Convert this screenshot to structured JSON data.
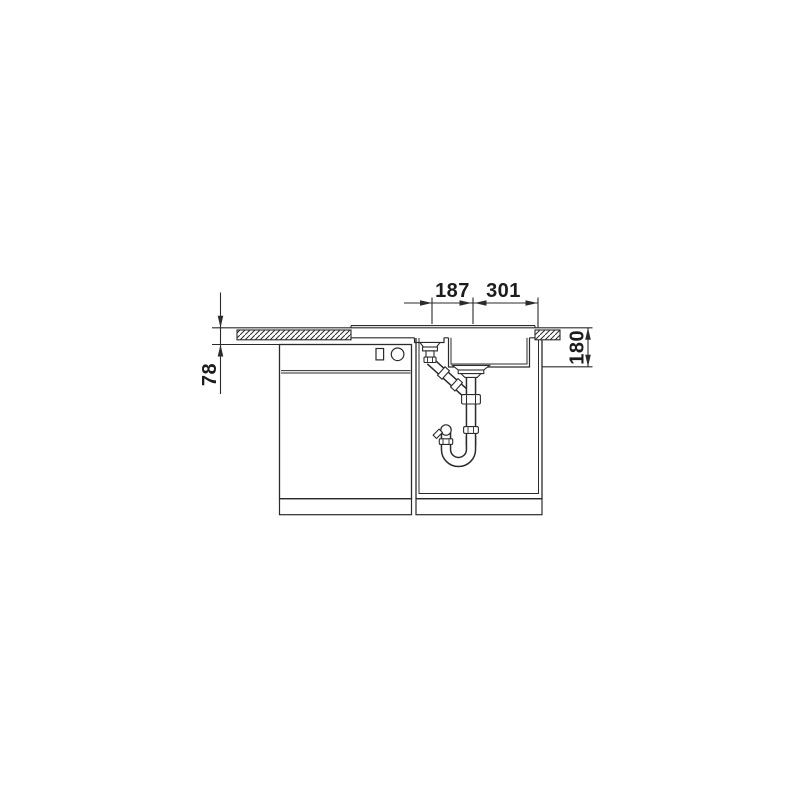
{
  "diagram": {
    "type": "technical-dimension-drawing",
    "subject": "Kitchen sink cross-section: one-and-a-half bowl inset sink in worktop with base cabinets and drain trap siphon",
    "background_color": "#ffffff",
    "line_color": "#2b2b2b",
    "dimensions": [
      {
        "label": "187",
        "orientation": "horizontal"
      },
      {
        "label": "301",
        "orientation": "horizontal"
      },
      {
        "label": "78",
        "orientation": "vertical"
      },
      {
        "label": "180",
        "orientation": "vertical"
      }
    ]
  }
}
